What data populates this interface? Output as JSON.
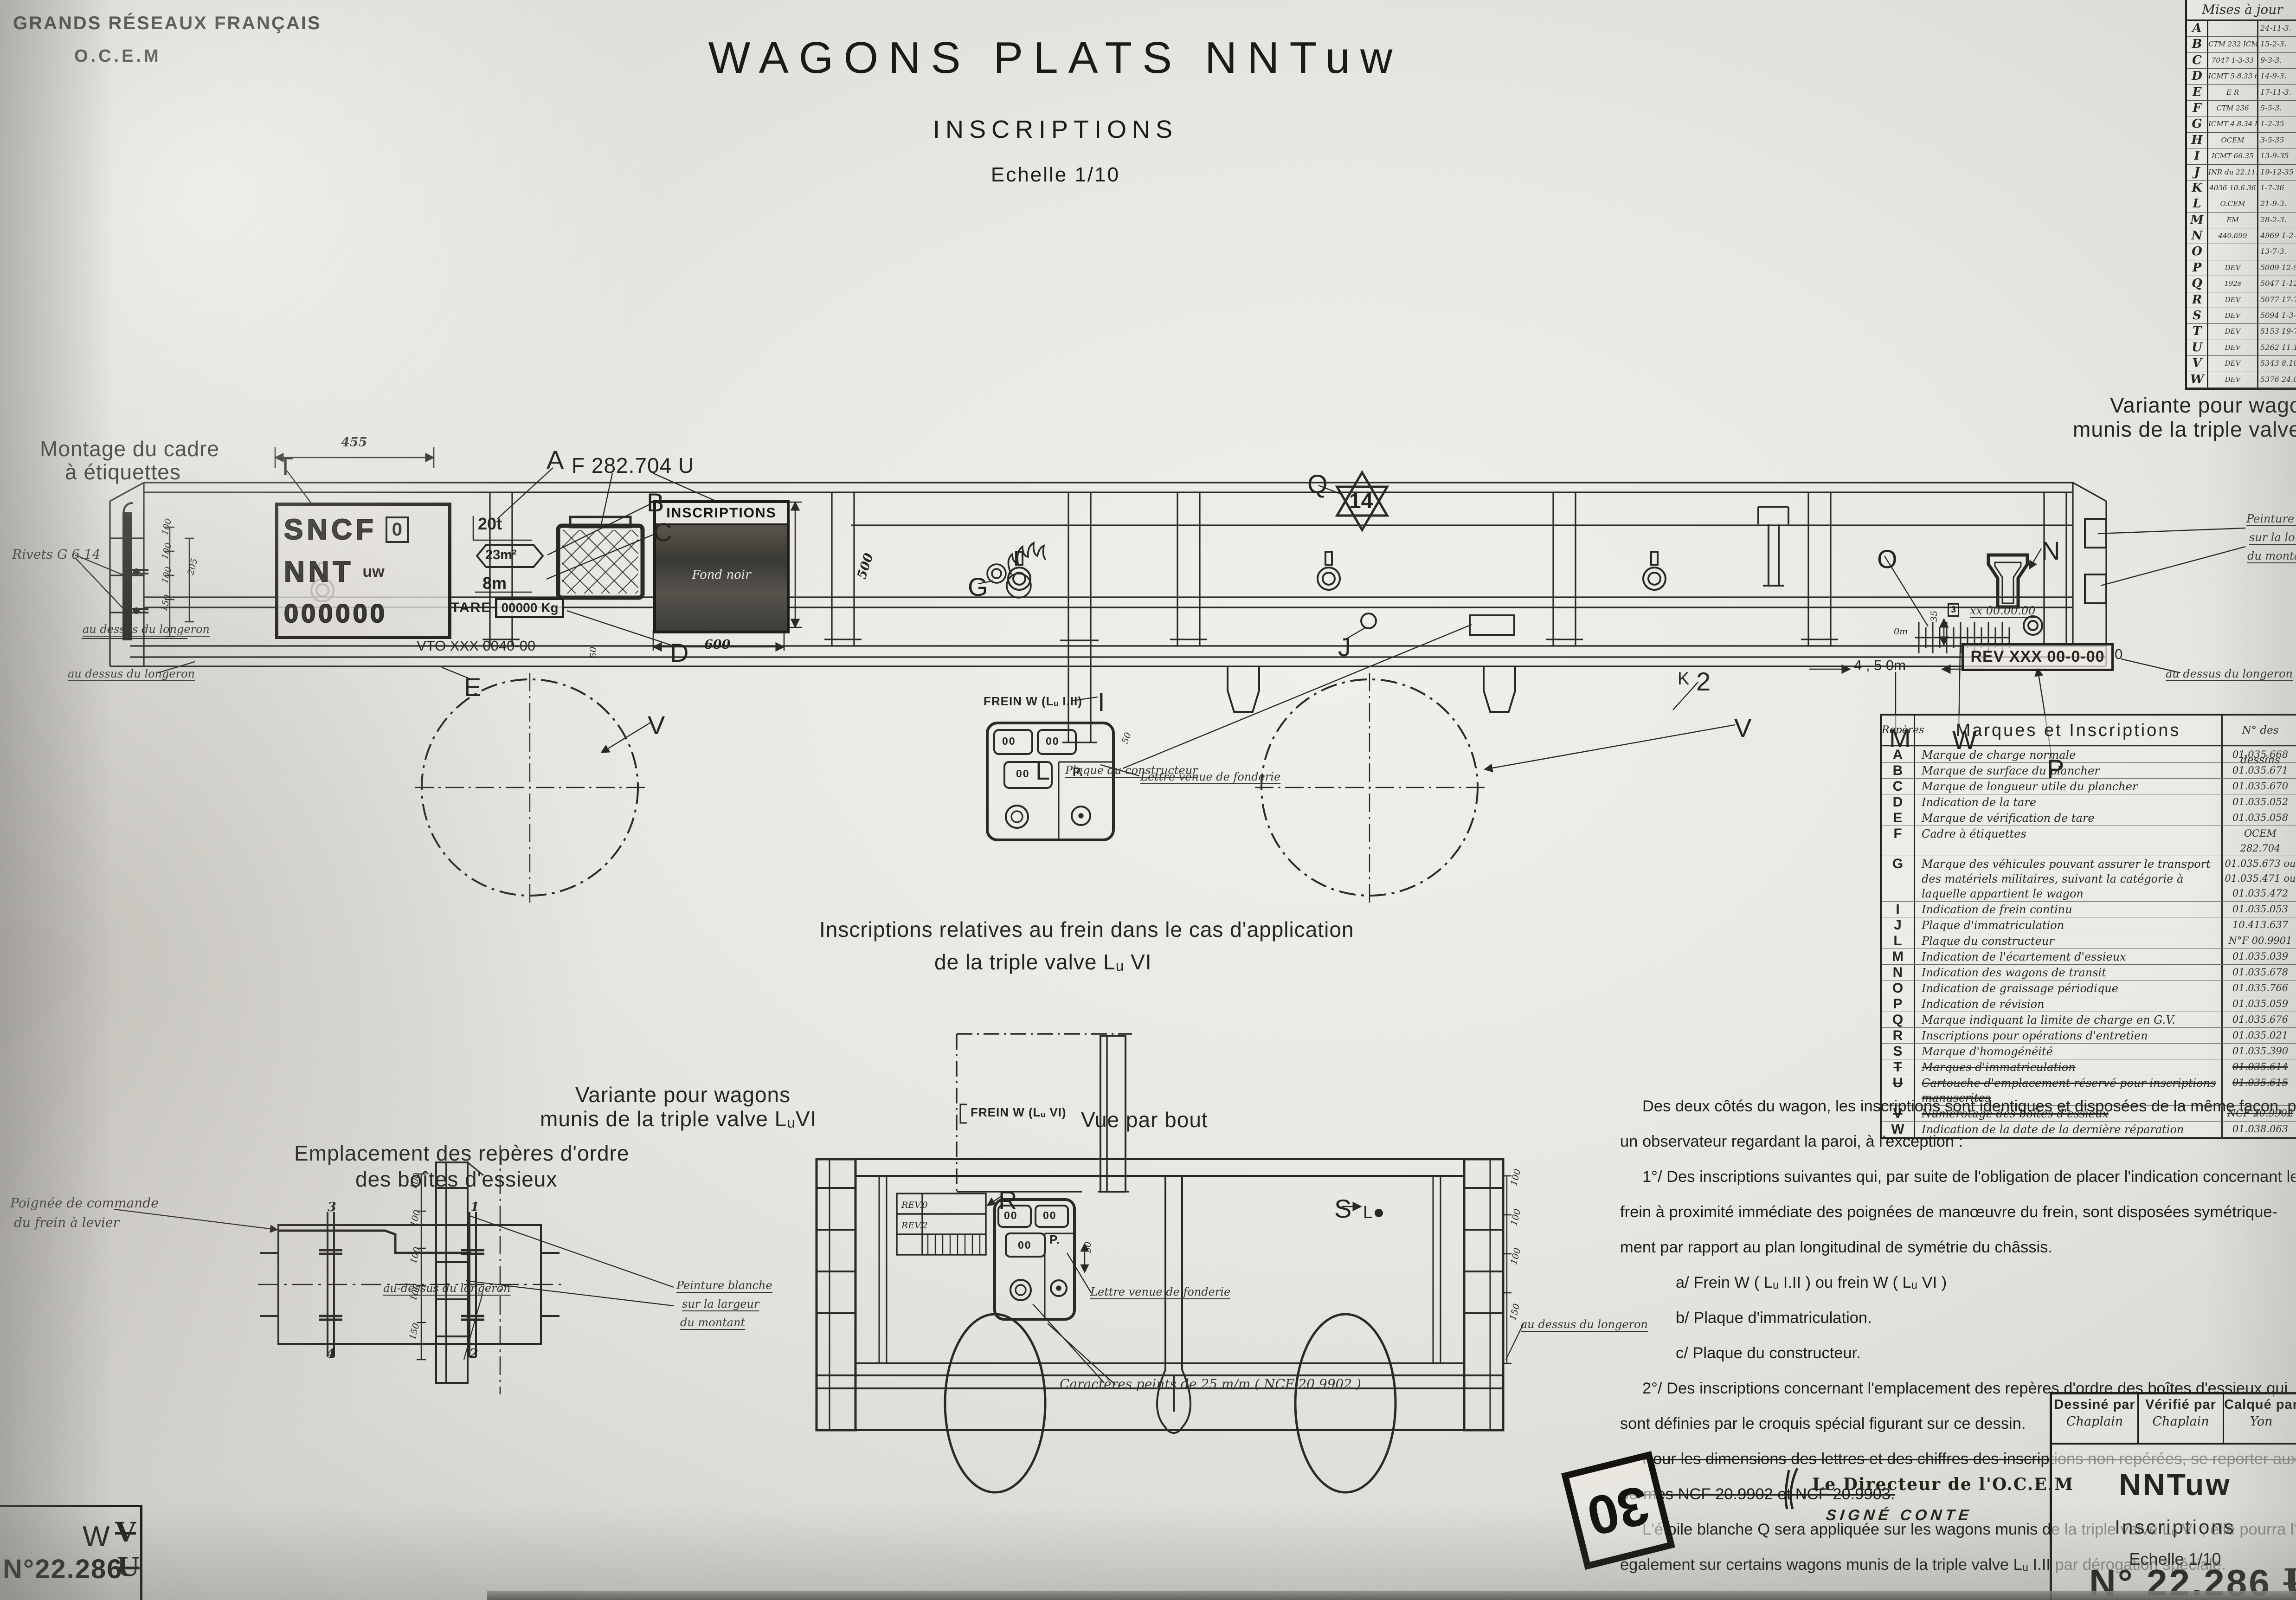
{
  "header": {
    "org_line1": "GRANDS RÉSEAUX FRANÇAIS",
    "org_line2": "O.C.E.M",
    "title": "WAGONS PLATS NNTuw",
    "subtitle": "INSCRIPTIONS",
    "scale": "Echelle 1/10"
  },
  "maj_table": {
    "title": "Mises à jour",
    "rows": [
      {
        "letter": "A",
        "ref": "",
        "date": "24-11-3."
      },
      {
        "letter": "B",
        "ref": "CTM 232 ICMT 26.1.32",
        "date": "15-2-3."
      },
      {
        "letter": "C",
        "ref": "7047 1-3-33",
        "date": "9-3-3."
      },
      {
        "letter": "D",
        "ref": "ICMT 5.8.33 654 2.9.33",
        "date": "14-9-3."
      },
      {
        "letter": "E",
        "ref": "E R",
        "date": "17-11-3."
      },
      {
        "letter": "F",
        "ref": "CTM 236",
        "date": "5-5-3."
      },
      {
        "letter": "G",
        "ref": "ICMT 4.8.34 ICMT 22.11.34",
        "date": "1-2-35"
      },
      {
        "letter": "H",
        "ref": "OCEM",
        "date": "3-5-35"
      },
      {
        "letter": "I",
        "ref": "ICMT 66.35",
        "date": "13-9-35"
      },
      {
        "letter": "J",
        "ref": "INR du 22.11.35",
        "date": "19-12-35"
      },
      {
        "letter": "K",
        "ref": "4036 10.6.36",
        "date": "1-7-36"
      },
      {
        "letter": "L",
        "ref": "O.CEM",
        "date": "21-9-3."
      },
      {
        "letter": "M",
        "ref": "EM",
        "date": "28-2-3."
      },
      {
        "letter": "N",
        "ref": "440.699",
        "date": "4969 1-2-38"
      },
      {
        "letter": "O",
        "ref": "",
        "date": "13-7-3."
      },
      {
        "letter": "P",
        "ref": "DEV",
        "date": "5009 12-9-3."
      },
      {
        "letter": "Q",
        "ref": "192s",
        "date": "5047 1-12-3."
      },
      {
        "letter": "R",
        "ref": "DEV",
        "date": "5077 17-7-3."
      },
      {
        "letter": "S",
        "ref": "DEV",
        "date": "5094 1-3-3."
      },
      {
        "letter": "T",
        "ref": "DEV",
        "date": "5153 19-7-3."
      },
      {
        "letter": "U",
        "ref": "DEV",
        "date": "5262 11.11.40"
      },
      {
        "letter": "V",
        "ref": "DEV",
        "date": "5343 8.10.42"
      },
      {
        "letter": "W",
        "ref": "DEV",
        "date": "5376 24.8.43"
      }
    ]
  },
  "marques_table": {
    "col_repere": "Repères",
    "col_marques": "Marques et Inscriptions",
    "col_dessins": "N° des dessins",
    "rows": [
      {
        "r": "A",
        "m": "Marque de charge normale",
        "n": "01.035.668"
      },
      {
        "r": "B",
        "m": "Marque de surface du plancher",
        "n": "01.035.671"
      },
      {
        "r": "C",
        "m": "Marque de longueur utile du plancher",
        "n": "01.035.670"
      },
      {
        "r": "D",
        "m": "Indication de la tare",
        "n": "01.035.052"
      },
      {
        "r": "E",
        "m": "Marque de vérification de tare",
        "n": "01.035.058"
      },
      {
        "r": "F",
        "m": "Cadre à étiquettes",
        "n": "OCEM 282.704"
      },
      {
        "r": "G",
        "m": "Marque des véhicules pouvant assurer le transport des matériels militaires, suivant la catégorie à laquelle appartient le wagon",
        "n": "01.035.673 ou 01.035.471 ou 01.035.472"
      },
      {
        "r": "I",
        "m": "Indication de frein continu",
        "n": "01.035.053"
      },
      {
        "r": "J",
        "m": "Plaque d'immatriculation",
        "n": "10.413.637"
      },
      {
        "r": "L",
        "m": "Plaque du constructeur",
        "n": "N°F 00.9901"
      },
      {
        "r": "M",
        "m": "Indication de l'écartement d'essieux",
        "n": "01.035.039"
      },
      {
        "r": "N",
        "m": "Indication des wagons de transit",
        "n": "01.035.678"
      },
      {
        "r": "O",
        "m": "Indication de graissage périodique",
        "n": "01.035.766"
      },
      {
        "r": "P",
        "m": "Indication de révision",
        "n": "01.035.059"
      },
      {
        "r": "Q",
        "m": "Marque indiquant la limite de charge en G.V.",
        "n": "01.035.676"
      },
      {
        "r": "R",
        "m": "Inscriptions pour opérations d'entretien",
        "n": "01.035.021"
      },
      {
        "r": "S",
        "m": "Marque d'homogénéité",
        "n": "01.035.390"
      },
      {
        "r": "T",
        "m": "Marques d'immatriculation",
        "n": "01.035.614",
        "struck": true
      },
      {
        "r": "U",
        "m": "Cartouche d'emplacement réservé pour inscriptions manuscrites",
        "n": "01.035.615",
        "struck": true
      },
      {
        "r": "V",
        "m": "Numérotage des boîtes d'essieux",
        "n": "NCF 20.9902",
        "struck": true
      },
      {
        "r": "W",
        "m": "Indication de la date de la dernière réparation",
        "n": "01.038.063"
      }
    ]
  },
  "notes": {
    "lines": [
      {
        "t": "Des deux côtés du wagon, les inscriptions sont identiques et disposées de la même façon, pour",
        "cls": "ind1"
      },
      {
        "t": "un observateur regardant la paroi, à l'exception :",
        "cls": ""
      },
      {
        "t": "1°/ Des inscriptions suivantes qui, par suite de l'obligation de placer l'indication concernant le",
        "cls": "ind1"
      },
      {
        "t": "frein à proximité immédiate des poignées de manœuvre du frein, sont disposées symétrique-",
        "cls": ""
      },
      {
        "t": "ment par rapport au plan longitudinal de symétrie du châssis.",
        "cls": ""
      },
      {
        "t": "a/ Frein W ( Lᵤ I.II ) ou frein W ( Lᵤ VI )",
        "cls": "ind2"
      },
      {
        "t": "b/ Plaque d'immatriculation.",
        "cls": "ind2"
      },
      {
        "t": "c/ Plaque du constructeur.",
        "cls": "ind2"
      },
      {
        "t": "2°/ Des inscriptions concernant l'emplacement des repères d'ordre des boîtes d'essieux qui",
        "cls": "ind1"
      },
      {
        "t": "sont définies par le croquis spécial figurant sur ce dessin.",
        "cls": ""
      },
      {
        "t": "Pour les dimensions des lettres et des chiffres des inscriptions non repérées, se reporter aux",
        "cls": "ind1",
        "struck": true
      },
      {
        "t": "normes NCF 20.9902 et NCF 20.9903.",
        "cls": "",
        "struck": true
      },
      {
        "t": "L'étoile blanche Q sera appliquée sur les wagons munis de la triple valve Lᵤ VI ; elle pourra l'être",
        "cls": "ind1"
      },
      {
        "t": "également sur certains wagons munis de la triple valve Lᵤ I.II par dérogation spéciale.",
        "cls": ""
      }
    ]
  },
  "plate": {
    "l1": "SNCF",
    "l1b": "0",
    "l2": "NNT",
    "l2b": "uw",
    "l3": "000000",
    "tare_label": "TARE",
    "tare_value": "00000 Kg"
  },
  "panel": {
    "title": "INSCRIPTIONS",
    "note": "Fond noir"
  },
  "rev_box": "REV XXX 00-0-00",
  "stamp": "30",
  "signature": {
    "line1": "Le Directeur de l'O.C.E.M",
    "line2": "SIGNÉ  CONTE"
  },
  "title_block": {
    "drawn_label": "Dessiné par",
    "drawn_name": "Chaplain",
    "checked_label": "Vérifié par",
    "checked_name": "Chaplain",
    "traced_label": "Calqué par",
    "traced_name": "Yon",
    "series": "NNTuw",
    "subject": "Inscriptions",
    "scale": "Echelle 1/10",
    "number": "N° 22.286",
    "struck_letter": "U",
    "suffix_letter": "W"
  },
  "corner_box": {
    "letter": "W",
    "struck_letter": "V",
    "number": "N°22.286",
    "struck_number_letter": "U"
  },
  "annotations": [
    {
      "t": "455",
      "x": 735,
      "y": 938,
      "cls": "dim"
    },
    {
      "t": "T",
      "x": 598,
      "y": 972,
      "cls": "callout"
    },
    {
      "t": "A",
      "x": 1178,
      "y": 958,
      "cls": "callout"
    },
    {
      "t": "B",
      "x": 1394,
      "y": 1050,
      "cls": "callout"
    },
    {
      "t": "C",
      "x": 1408,
      "y": 1114,
      "cls": "callout"
    },
    {
      "t": "D",
      "x": 1444,
      "y": 1374,
      "cls": "callout"
    },
    {
      "t": "E",
      "x": 1000,
      "y": 1448,
      "cls": "callout"
    },
    {
      "t": "F 282.704 U",
      "x": 1232,
      "y": 976,
      "cls": "draft-lg"
    },
    {
      "t": "20t",
      "x": 1030,
      "y": 1108,
      "cls": "plate-num"
    },
    {
      "t": "23m²",
      "x": 1046,
      "y": 1180,
      "cls": "plate-num-sm"
    },
    {
      "t": "8m",
      "x": 1040,
      "y": 1236,
      "cls": "plate-num"
    },
    {
      "t": "VTO XXX 0040-00",
      "x": 898,
      "y": 1374,
      "cls": "draft-sm"
    },
    {
      "t": "G",
      "x": 2086,
      "y": 1232,
      "cls": "callout"
    },
    {
      "t": "Q",
      "x": 2818,
      "y": 1010,
      "cls": "callout"
    },
    {
      "t": "14",
      "x": 2908,
      "y": 1052,
      "cls": "star-num"
    },
    {
      "t": "FREIN W (Lᵤ I.II)",
      "x": 2120,
      "y": 1496,
      "cls": "draft-xs"
    },
    {
      "t": "I",
      "x": 2366,
      "y": 1480,
      "cls": "callout"
    },
    {
      "t": "J",
      "x": 2884,
      "y": 1362,
      "cls": "callout"
    },
    {
      "t": "L",
      "x": 2232,
      "y": 1628,
      "cls": "callout"
    },
    {
      "t": "Plaque du constructeur",
      "x": 2296,
      "y": 1646,
      "cls": "hand-xs"
    },
    {
      "t": "Lettre venue de fonderie",
      "x": 2458,
      "y": 1660,
      "cls": "hand-xs"
    },
    {
      "t": "50",
      "x": 2414,
      "y": 1598,
      "cls": "micro",
      "rot": -70
    },
    {
      "t": "P.",
      "x": 2312,
      "y": 1648,
      "cls": "draft-xs"
    },
    {
      "t": "00",
      "x": 2160,
      "y": 1584,
      "cls": "cast-num"
    },
    {
      "t": "00",
      "x": 2254,
      "y": 1584,
      "cls": "cast-num"
    },
    {
      "t": "00",
      "x": 2190,
      "y": 1654,
      "cls": "cast-num"
    },
    {
      "t": "K",
      "x": 3616,
      "y": 1442,
      "cls": "callout-sm"
    },
    {
      "t": "2",
      "x": 3656,
      "y": 1436,
      "cls": "callout"
    },
    {
      "t": "V",
      "x": 1396,
      "y": 1530,
      "cls": "callout"
    },
    {
      "t": "V",
      "x": 3738,
      "y": 1536,
      "cls": "callout"
    },
    {
      "t": "M",
      "x": 4072,
      "y": 1558,
      "cls": "callout"
    },
    {
      "t": "W",
      "x": 4208,
      "y": 1562,
      "cls": "callout"
    },
    {
      "t": "P",
      "x": 4412,
      "y": 1624,
      "cls": "callout"
    },
    {
      "t": "N",
      "x": 4400,
      "y": 1154,
      "cls": "callout"
    },
    {
      "t": "O",
      "x": 4046,
      "y": 1172,
      "cls": "callout"
    },
    {
      "t": "0m",
      "x": 4082,
      "y": 1350,
      "cls": "micro"
    },
    {
      "t": "3",
      "x": 4198,
      "y": 1300,
      "cls": "boxed-micro"
    },
    {
      "t": "xx 00.00.00",
      "x": 4246,
      "y": 1302,
      "cls": "hand-xs"
    },
    {
      "t": "35",
      "x": 4158,
      "y": 1340,
      "cls": "micro",
      "rot": -90
    },
    {
      "t": "0",
      "x": 4558,
      "y": 1392,
      "cls": "draft-sm"
    },
    {
      "t": "4 , 5 0m",
      "x": 3996,
      "y": 1416,
      "cls": "draft-sm"
    },
    {
      "t": "600",
      "x": 1518,
      "y": 1374,
      "cls": "dim"
    },
    {
      "t": "500",
      "x": 1842,
      "y": 1242,
      "cls": "dim",
      "rot": -72
    },
    {
      "t": "50",
      "x": 1268,
      "y": 1418,
      "cls": "micro",
      "rot": -90
    },
    {
      "t": "Peinture blanche",
      "x": 4842,
      "y": 1104,
      "cls": "hand-xs"
    },
    {
      "t": "sur la longueur",
      "x": 4848,
      "y": 1144,
      "cls": "hand-xs"
    },
    {
      "t": "du montant",
      "x": 4844,
      "y": 1184,
      "cls": "hand-xs"
    },
    {
      "t": "au dessus du longeron",
      "x": 4668,
      "y": 1438,
      "cls": "hand-xs"
    },
    {
      "t": "au dessus du longeron",
      "x": 146,
      "y": 1438,
      "cls": "hand-xs"
    },
    {
      "t": "Montage du cadre",
      "x": 86,
      "y": 940,
      "cls": "draft-lg"
    },
    {
      "t": "à étiquettes",
      "x": 140,
      "y": 990,
      "cls": "draft-lg"
    },
    {
      "t": "Rivets G 6.14",
      "x": 26,
      "y": 1178,
      "cls": "hand-sm"
    },
    {
      "t": "au dessus du longeron",
      "x": 178,
      "y": 1342,
      "cls": "hand-xs"
    },
    {
      "t": "100",
      "x": 344,
      "y": 1150,
      "cls": "micro",
      "rot": -75
    },
    {
      "t": "100",
      "x": 344,
      "y": 1202,
      "cls": "micro",
      "rot": -75
    },
    {
      "t": "100",
      "x": 344,
      "y": 1254,
      "cls": "micro",
      "rot": -75
    },
    {
      "t": "150",
      "x": 342,
      "y": 1314,
      "cls": "micro",
      "rot": -75
    },
    {
      "t": "205",
      "x": 400,
      "y": 1236,
      "cls": "micro",
      "rot": -75
    },
    {
      "t": "Variante pour wagons",
      "x": 4548,
      "y": 846,
      "cls": "draft-lg"
    },
    {
      "t": "munis de la triple valve Lᵤv",
      "x": 4468,
      "y": 898,
      "cls": "draft-lg"
    },
    {
      "t": "Inscriptions relatives au frein dans le cas d'application",
      "x": 1766,
      "y": 1976,
      "cls": "draft-lg"
    },
    {
      "t": "de la triple valve Lᵤ VI",
      "x": 2014,
      "y": 2046,
      "cls": "draft-lg"
    },
    {
      "t": "FREIN W (Lᵤ VI)",
      "x": 2092,
      "y": 2382,
      "cls": "draft-xs"
    },
    {
      "t": "P.",
      "x": 2262,
      "y": 2656,
      "cls": "draft-xs"
    },
    {
      "t": "00",
      "x": 2164,
      "y": 2606,
      "cls": "cast-num"
    },
    {
      "t": "00",
      "x": 2248,
      "y": 2606,
      "cls": "cast-num"
    },
    {
      "t": "00",
      "x": 2194,
      "y": 2670,
      "cls": "cast-num"
    },
    {
      "t": "50",
      "x": 2334,
      "y": 2700,
      "cls": "micro",
      "rot": -90
    },
    {
      "t": "Lettre venue de fonderie",
      "x": 2350,
      "y": 2770,
      "cls": "hand-xs"
    },
    {
      "t": "Caractères peints de 25 m/m ( NCF 20.9902 )",
      "x": 2284,
      "y": 2966,
      "cls": "hand-sm"
    },
    {
      "t": "Variante pour wagons",
      "x": 1240,
      "y": 2332,
      "cls": "draft-lg"
    },
    {
      "t": "munis de la triple valve LᵤVI",
      "x": 1164,
      "y": 2384,
      "cls": "draft-lg"
    },
    {
      "t": "Emplacement des repères d'ordre",
      "x": 634,
      "y": 2458,
      "cls": "draft-lg"
    },
    {
      "t": "des boîtes d'essieux",
      "x": 766,
      "y": 2514,
      "cls": "draft-lg"
    },
    {
      "t": "Poignée de commande",
      "x": 22,
      "y": 2576,
      "cls": "hand-sm"
    },
    {
      "t": "du frein à levier",
      "x": 30,
      "y": 2618,
      "cls": "hand-sm"
    },
    {
      "t": "3",
      "x": 706,
      "y": 2586,
      "cls": "dim"
    },
    {
      "t": "1",
      "x": 1014,
      "y": 2586,
      "cls": "dim"
    },
    {
      "t": "4",
      "x": 704,
      "y": 2902,
      "cls": "dim"
    },
    {
      "t": "2",
      "x": 1012,
      "y": 2902,
      "cls": "dim"
    },
    {
      "t": "Peinture blanche",
      "x": 1458,
      "y": 2756,
      "cls": "hand-xs"
    },
    {
      "t": "sur la largeur",
      "x": 1470,
      "y": 2796,
      "cls": "hand-xs"
    },
    {
      "t": "du montant",
      "x": 1466,
      "y": 2836,
      "cls": "hand-xs"
    },
    {
      "t": "au-dessus du longeron",
      "x": 826,
      "y": 2762,
      "cls": "hand-xs"
    },
    {
      "t": "100",
      "x": 880,
      "y": 2560,
      "cls": "micro",
      "rot": -75
    },
    {
      "t": "100",
      "x": 880,
      "y": 2640,
      "cls": "micro",
      "rot": -75
    },
    {
      "t": "100",
      "x": 880,
      "y": 2720,
      "cls": "micro",
      "rot": -75
    },
    {
      "t": "100",
      "x": 880,
      "y": 2800,
      "cls": "micro",
      "rot": -75
    },
    {
      "t": "150",
      "x": 878,
      "y": 2884,
      "cls": "micro",
      "rot": -75
    },
    {
      "t": "Vue par bout",
      "x": 2330,
      "y": 2386,
      "cls": "draft-lg"
    },
    {
      "t": "R",
      "x": 2152,
      "y": 2554,
      "cls": "callout"
    },
    {
      "t": "REV.0",
      "x": 1943,
      "y": 2586,
      "cls": "micro"
    },
    {
      "t": "REV.2",
      "x": 1943,
      "y": 2630,
      "cls": "micro"
    },
    {
      "t": "S",
      "x": 2876,
      "y": 2572,
      "cls": "callout"
    },
    {
      "t": "L",
      "x": 2938,
      "y": 2592,
      "cls": "callout-sm"
    },
    {
      "t": "100",
      "x": 3252,
      "y": 2552,
      "cls": "micro",
      "rot": -75
    },
    {
      "t": "100",
      "x": 3252,
      "y": 2638,
      "cls": "micro",
      "rot": -75
    },
    {
      "t": "100",
      "x": 3252,
      "y": 2722,
      "cls": "micro",
      "rot": -75
    },
    {
      "t": "150",
      "x": 3250,
      "y": 2842,
      "cls": "micro",
      "rot": -75
    },
    {
      "t": "au dessus du longeron",
      "x": 3278,
      "y": 2840,
      "cls": "hand-xs"
    }
  ]
}
